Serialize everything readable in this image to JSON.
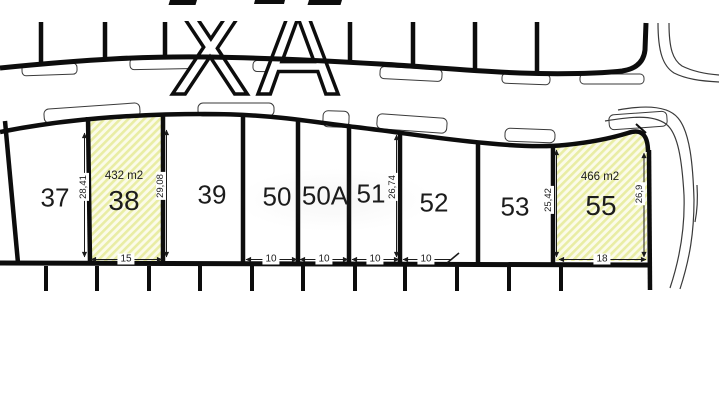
{
  "map": {
    "street_letters": "XA",
    "plots": [
      {
        "id": "37",
        "label": "37"
      },
      {
        "id": "38",
        "label": "38",
        "area": "432 m2",
        "width": "15",
        "dim_left": "28,41",
        "dim_right": "29,08",
        "highlighted": true
      },
      {
        "id": "39",
        "label": "39"
      },
      {
        "id": "50",
        "label": "50",
        "width": "10"
      },
      {
        "id": "50A",
        "label": "50A",
        "width": "10"
      },
      {
        "id": "51",
        "label": "51",
        "width": "10",
        "dim_right": "26,74"
      },
      {
        "id": "52",
        "label": "52",
        "width": "10"
      },
      {
        "id": "53",
        "label": "53"
      },
      {
        "id": "55",
        "label": "55",
        "area": "466 m2",
        "width": "18",
        "dim_left": "25,42",
        "dim_right": "26,9",
        "highlighted": true
      }
    ],
    "colors": {
      "line": "#0d0d0d",
      "thin_line": "#3a3a3a",
      "highlight_base": "#fbfbe9",
      "highlight_stripe": "#e9eda4"
    }
  }
}
